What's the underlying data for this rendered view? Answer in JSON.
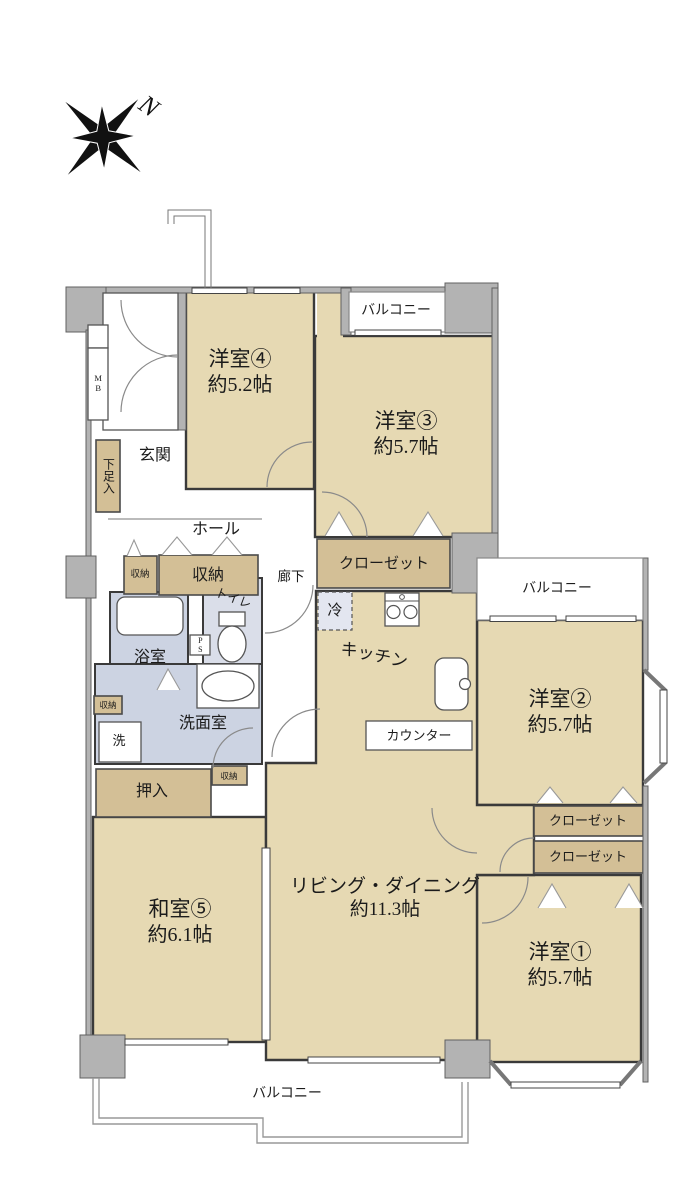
{
  "compass": {
    "north_label": "N"
  },
  "rooms": {
    "western4": {
      "name": "洋室④",
      "size": "約5.2帖"
    },
    "western3": {
      "name": "洋室③",
      "size": "約5.7帖"
    },
    "western2": {
      "name": "洋室②",
      "size": "約5.7帖"
    },
    "western1": {
      "name": "洋室①",
      "size": "約5.7帖"
    },
    "japanese5": {
      "name": "和室⑤",
      "size": "約6.1帖"
    },
    "living": {
      "name": "リビング・ダイニング",
      "size": "約11.3帖"
    },
    "kitchen": "キッチン",
    "entrance": "玄関",
    "hall": "ホール",
    "corridor": "廊下",
    "toilet": "トイレ",
    "bath": "浴室",
    "washroom": "洗面室"
  },
  "labels": {
    "balcony_top": "バルコニー",
    "balcony_right": "バルコニー",
    "balcony_bottom": "バルコニー",
    "closet_room3": "クローゼット",
    "closet_upper": "クローゼット",
    "closet_lower": "クローゼット",
    "storage_hall_small": "収納",
    "storage_hall_large": "収納",
    "storage_washroom": "収納",
    "storage_japanese": "収納",
    "oshiire": "押入",
    "shoe_cabinet": "下足入",
    "meter_box": "MB",
    "pipe_space": "PS",
    "refrigerator": "冷",
    "washer": "洗",
    "counter": "カウンター"
  },
  "colors": {
    "room_fill": "#e6d9b3",
    "closet_fill": "#d3bf96",
    "sanitary_fill": "#ccd3e2",
    "toilet_fill": "#dadee9",
    "wall_gray": "#b3b3b3",
    "line": "#3a3a3a"
  }
}
